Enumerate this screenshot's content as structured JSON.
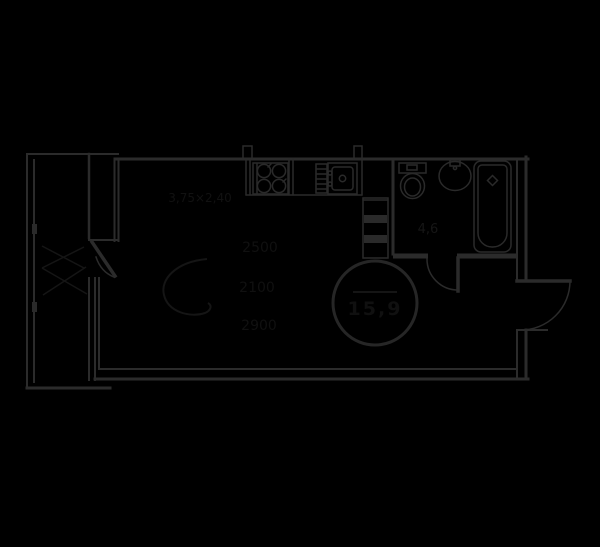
{
  "canvas": {
    "width": 600,
    "height": 547,
    "background": "#000000"
  },
  "colors": {
    "wall_line": "#2b2b2b",
    "fixture_line": "#2a2a2a",
    "stamp_circle": "#262626",
    "faint_ink": "#121212"
  },
  "plan": {
    "type": "studio-apartment-floor-plan",
    "area_stamp": {
      "shape": "circle",
      "value": "15,9"
    },
    "bathroom_area_label": "4,6",
    "room_dimension_label": "3,75×2,40",
    "faint_annotations": {
      "row1": "2500",
      "row2": "2100",
      "row3": "2900"
    },
    "rooms": [
      {
        "name": "balcony"
      },
      {
        "name": "living-room-with-kitchen"
      },
      {
        "name": "bathroom"
      },
      {
        "name": "entry-hall"
      }
    ],
    "fixtures": [
      "stove-4-burner",
      "drainboard",
      "kitchen-sink",
      "vent-shaft",
      "toilet",
      "washbasin",
      "bathtub"
    ],
    "doors": [
      "balcony-door",
      "bathroom-door",
      "entrance-door"
    ]
  }
}
